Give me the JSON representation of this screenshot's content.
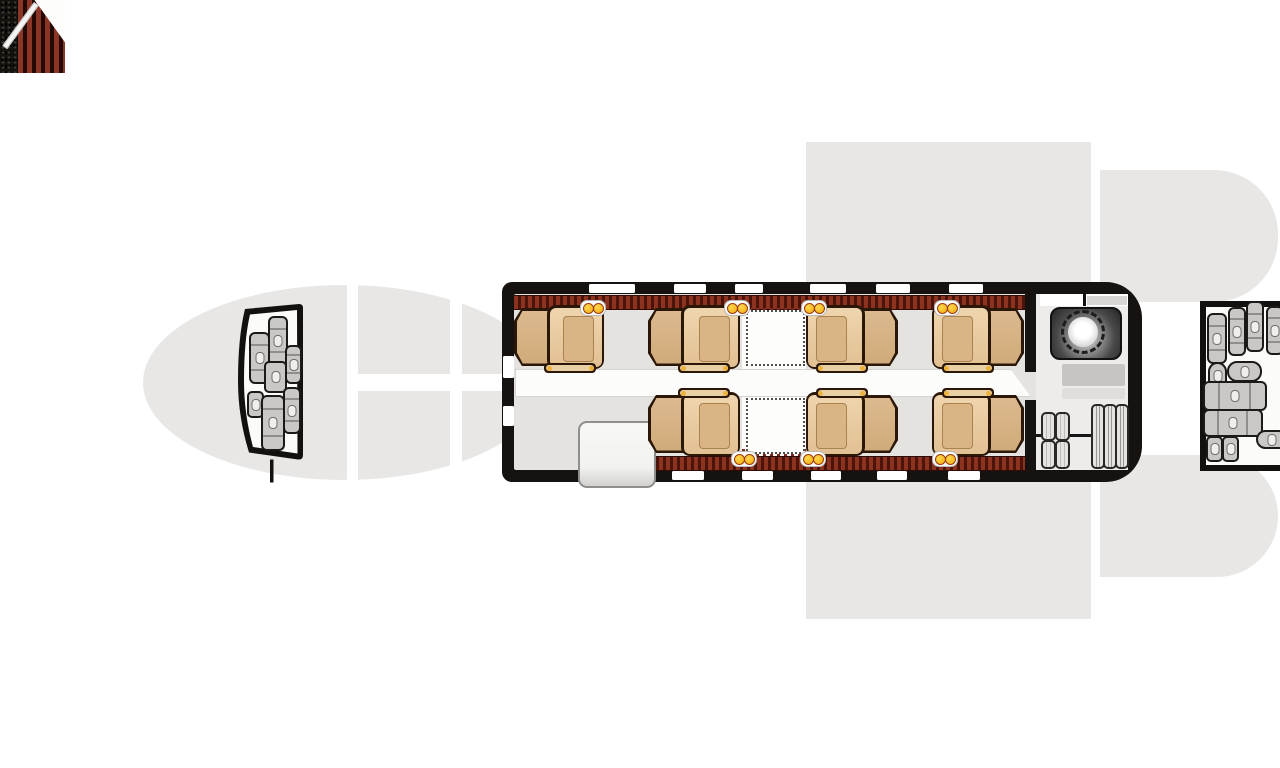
{
  "canvas": {
    "width": 1280,
    "height": 768,
    "background": "#ffffff"
  },
  "palette": {
    "silhouette_gray": "#e8e7e5",
    "frame_black": "#15120f",
    "floor_gray": "#e4e3e0",
    "aisle_white": "#fcfcfb",
    "sideledge_red": "#8c3320",
    "sideledge_dark": "#4a140a",
    "seat_tan_light": "#efd5ae",
    "seat_tan_mid": "#dcba8e",
    "seat_tan_dark": "#d9b586",
    "seat_outline": "#2b1708",
    "cupholder_amber": "#f0a90a",
    "cupholder_ring": "#9c3a10",
    "stairs_red": "#8a3526",
    "luggage_gray": "#c9c8c6",
    "toilet_dark": "#262626",
    "counter_gray": "#c6c5c3"
  },
  "silhouette": {
    "nose_ellipse": {
      "x": 143,
      "y": 285,
      "w": 402,
      "h": 195
    },
    "gap_bands_vertical": [
      {
        "x": 347,
        "y": 280,
        "w": 11,
        "h": 205
      },
      {
        "x": 450,
        "y": 280,
        "w": 12,
        "h": 205
      }
    ],
    "gap_band_horizontal": {
      "x": 347,
      "y": 374,
      "w": 156,
      "h": 17
    },
    "wing_band": {
      "x": 806,
      "y": 142,
      "w": 285,
      "h": 477
    },
    "wing_gap_strip": {
      "x": 1091,
      "y": 142,
      "w": 9,
      "h": 477
    },
    "tail_top_lobe": {
      "x": 1100,
      "y": 170,
      "w": 178,
      "h": 132
    },
    "tail_bottom_lobe": {
      "x": 1100,
      "y": 455,
      "w": 178,
      "h": 122
    }
  },
  "nose_baggage": {
    "name": "nose-baggage-compartment",
    "origin": {
      "x": 237,
      "y": 295,
      "w": 72,
      "h": 190
    },
    "outer_path": "M 8,14 L 62,9 Q 66,9 66,13 L 66,160 Q 66,165 61,164.5 L 12,157.5 Q 1,122 1,86 Q 1,42 8,14 Z",
    "inner_path": "M 13,19.5 L 60,15 L 60.5,158.5 L 16,152 Q 7,119 7,86 Q 7,45 13,19.5 Z",
    "stem": {
      "x": 33,
      "y": 164.5,
      "w": 3.5,
      "h": 23
    },
    "items": [
      {
        "type": "suitcase-v",
        "x": 249,
        "y": 332,
        "w": 17,
        "h": 48
      },
      {
        "type": "suitcase-v",
        "x": 268,
        "y": 316,
        "w": 16,
        "h": 46
      },
      {
        "type": "case-v",
        "x": 285,
        "y": 345,
        "w": 13,
        "h": 35
      },
      {
        "type": "bag",
        "x": 264,
        "y": 361,
        "w": 19,
        "h": 28
      },
      {
        "type": "bag-small",
        "x": 247,
        "y": 391,
        "w": 13,
        "h": 23
      },
      {
        "type": "suitcase-v",
        "x": 261,
        "y": 395,
        "w": 20,
        "h": 52
      },
      {
        "type": "case-v",
        "x": 283,
        "y": 387,
        "w": 14,
        "h": 43
      }
    ]
  },
  "cabin": {
    "name": "main-cabin",
    "frame": {
      "x": 502,
      "y": 282,
      "w": 640,
      "h": 200
    },
    "floor": {
      "x": 514,
      "y": 294,
      "w": 614,
      "h": 176
    },
    "lav_floor": {
      "x": 1036,
      "y": 294,
      "w": 92,
      "h": 176
    },
    "table_zone": {
      "x": 742,
      "y": 307,
      "w": 64,
      "h": 150
    },
    "aisle": {
      "x": 515,
      "y": 369,
      "w": 514,
      "h": 26
    },
    "sideledge_top": {
      "x": 514,
      "y": 295,
      "w": 514,
      "h": 13
    },
    "sideledge_bottom": {
      "x": 652,
      "y": 456,
      "w": 376,
      "h": 13
    },
    "fringe_top": {
      "x": 742,
      "y": 308,
      "w": 64,
      "h": 7
    },
    "fringe_bottom": {
      "x": 742,
      "y": 449,
      "w": 64,
      "h": 7
    },
    "windows_top": [
      {
        "x": 589,
        "w": 46
      },
      {
        "x": 674,
        "w": 32
      },
      {
        "x": 735,
        "w": 28
      },
      {
        "x": 810,
        "w": 36
      },
      {
        "x": 876,
        "w": 34
      },
      {
        "x": 949,
        "w": 34
      }
    ],
    "windows_bottom": [
      {
        "x": 672,
        "w": 32
      },
      {
        "x": 742,
        "w": 31
      },
      {
        "x": 811,
        "w": 30
      },
      {
        "x": 877,
        "w": 30
      },
      {
        "x": 948,
        "w": 32
      }
    ],
    "left_slots": [
      {
        "y": 356,
        "h": 22
      },
      {
        "y": 406,
        "h": 20
      }
    ],
    "seats": [
      {
        "id": "seat-1",
        "x": 514,
        "y": 305,
        "w": 90,
        "h": 64,
        "facing": "right",
        "row": "top"
      },
      {
        "id": "seat-2",
        "x": 648,
        "y": 305,
        "w": 92,
        "h": 64,
        "facing": "right",
        "row": "top"
      },
      {
        "id": "seat-3",
        "x": 806,
        "y": 305,
        "w": 92,
        "h": 64,
        "facing": "left",
        "row": "top"
      },
      {
        "id": "seat-4",
        "x": 932,
        "y": 305,
        "w": 92,
        "h": 64,
        "facing": "left",
        "row": "top"
      },
      {
        "id": "seat-5",
        "x": 648,
        "y": 392,
        "w": 92,
        "h": 64,
        "facing": "right",
        "row": "bottom"
      },
      {
        "id": "seat-6",
        "x": 806,
        "y": 392,
        "w": 92,
        "h": 64,
        "facing": "left",
        "row": "bottom"
      },
      {
        "id": "seat-7",
        "x": 932,
        "y": 392,
        "w": 92,
        "h": 64,
        "facing": "left",
        "row": "bottom"
      }
    ],
    "tables": [
      {
        "x": 746,
        "y": 310,
        "w": 55,
        "h": 52
      },
      {
        "x": 746,
        "y": 398,
        "w": 55,
        "h": 52
      }
    ],
    "cupholders_top": [
      592,
      736,
      813,
      946
    ],
    "cupholders_bottom": [
      743,
      812,
      944
    ],
    "entry": {
      "x": 515,
      "y": 406,
      "w": 65,
      "h": 73,
      "speckle_w": 20
    },
    "cabinet": {
      "x": 578,
      "y": 421,
      "w": 74,
      "h": 63
    },
    "partition_segments": [
      {
        "x": 1025,
        "y": 294,
        "w": 11,
        "h": 78
      },
      {
        "x": 1025,
        "y": 400,
        "w": 11,
        "h": 70
      }
    ],
    "lavatory": {
      "wall_strip": {
        "x": 1040,
        "y": 294,
        "w": 88,
        "h": 12
      },
      "wall_tick": {
        "x": 1083,
        "y": 293,
        "w": 3,
        "h": 13
      },
      "wall_shade": {
        "x": 1087,
        "y": 296,
        "w": 40,
        "h": 9
      },
      "toilet": {
        "x": 1050,
        "y": 307,
        "w": 68,
        "h": 49
      },
      "bowl": {
        "cx": 1083,
        "cy": 332,
        "r": 15
      },
      "counter": {
        "x": 1062,
        "y": 364,
        "w": 63,
        "h": 22
      },
      "counter_shelf": {
        "x": 1062,
        "y": 388,
        "w": 63,
        "h": 11
      }
    },
    "wardrobe": {
      "rail": {
        "x": 1033,
        "y": 434,
        "w": 95,
        "h": 3
      },
      "pills_small": [
        {
          "x": 1041,
          "y": 412,
          "w": 11,
          "h": 25
        },
        {
          "x": 1055,
          "y": 412,
          "w": 11,
          "h": 25
        },
        {
          "x": 1041,
          "y": 440,
          "w": 11,
          "h": 25
        },
        {
          "x": 1055,
          "y": 440,
          "w": 11,
          "h": 25
        }
      ],
      "pills_tall": [
        {
          "x": 1091,
          "y": 404,
          "w": 10,
          "h": 61
        },
        {
          "x": 1103,
          "y": 404,
          "w": 10,
          "h": 61
        },
        {
          "x": 1115,
          "y": 404,
          "w": 10,
          "h": 61
        }
      ]
    }
  },
  "aft_baggage": {
    "name": "aft-baggage-compartment",
    "panel": {
      "x": 1200,
      "y": 301,
      "w": 92,
      "h": 158
    },
    "items": [
      {
        "type": "suitcase-v",
        "x": 1207,
        "y": 313,
        "w": 16,
        "h": 47
      },
      {
        "type": "suitcase-v",
        "x": 1228,
        "y": 307,
        "w": 14,
        "h": 45
      },
      {
        "type": "suitcase-v",
        "x": 1246,
        "y": 301,
        "w": 14,
        "h": 47
      },
      {
        "type": "suitcase-v",
        "x": 1266,
        "y": 306,
        "w": 14,
        "h": 45
      },
      {
        "type": "duffel-v",
        "x": 1208,
        "y": 362,
        "w": 15,
        "h": 24
      },
      {
        "type": "duffel-h",
        "x": 1227,
        "y": 361,
        "w": 31,
        "h": 17
      },
      {
        "type": "suitcase-h",
        "x": 1203,
        "y": 381,
        "w": 60,
        "h": 26
      },
      {
        "type": "suitcase-h",
        "x": 1203,
        "y": 409,
        "w": 56,
        "h": 24
      },
      {
        "type": "bag-small",
        "x": 1206,
        "y": 436,
        "w": 13,
        "h": 22
      },
      {
        "type": "bag-small",
        "x": 1222,
        "y": 436,
        "w": 13,
        "h": 22
      },
      {
        "type": "duffel-h",
        "x": 1256,
        "y": 430,
        "w": 28,
        "h": 15
      }
    ]
  }
}
